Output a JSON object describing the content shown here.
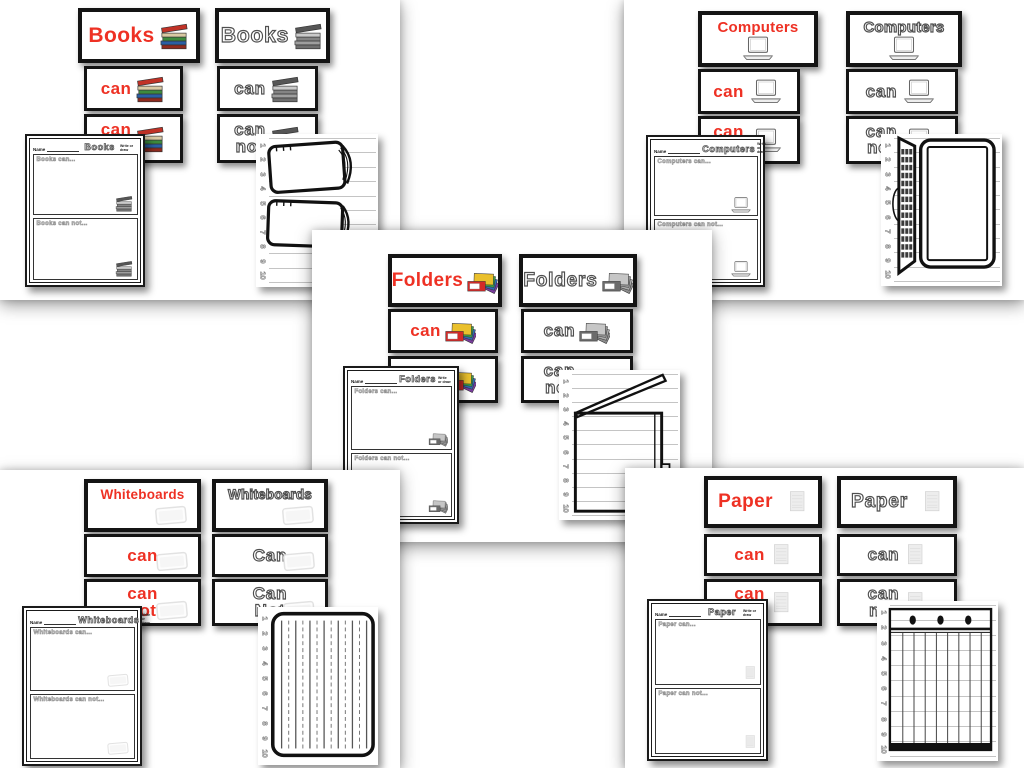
{
  "colors": {
    "accent_red": "#ee3124",
    "card_border": "#141414",
    "outline_text_gray": "#4f4f4f"
  },
  "shared": {
    "name_label": "Name",
    "corner_note": "Write or draw",
    "line_numbers": [
      "1",
      "2",
      "3",
      "4",
      "5",
      "6",
      "7",
      "8",
      "9",
      "10"
    ]
  },
  "sections": [
    {
      "id": "books",
      "title": "Books",
      "cards": {
        "red_title": "Books",
        "red_can": "can",
        "red_cannot_1": "can",
        "red_cannot_2": "not",
        "outline_title": "Books",
        "outline_can": "can",
        "outline_cannot_1": "can",
        "outline_cannot_2": "not"
      },
      "worksheet": {
        "title": "Books",
        "can_prompt": "Books can...",
        "cannot_prompt": "Books can not..."
      }
    },
    {
      "id": "computers",
      "title": "Computers",
      "cards": {
        "red_title": "Computers",
        "red_can": "can",
        "red_cannot_1": "can",
        "red_cannot_2": "not",
        "outline_title": "Computers",
        "outline_can": "can",
        "outline_cannot_1": "can",
        "outline_cannot_2": "not"
      },
      "worksheet": {
        "title": "Computers",
        "can_prompt": "Computers can...",
        "cannot_prompt": "Computers can not..."
      }
    },
    {
      "id": "folders",
      "title": "Folders",
      "cards": {
        "red_title": "Folders",
        "red_can": "can",
        "red_cannot_1": "can",
        "red_cannot_2": "not",
        "outline_title": "Folders",
        "outline_can": "can",
        "outline_cannot_1": "can",
        "outline_cannot_2": "not"
      },
      "worksheet": {
        "title": "Folders",
        "can_prompt": "Folders can...",
        "cannot_prompt": "Folders can not..."
      }
    },
    {
      "id": "whiteboards",
      "title": "Whiteboards",
      "cards": {
        "red_title": "Whiteboards",
        "red_can": "can",
        "red_cannot_1": "can",
        "red_cannot_2": "not",
        "outline_title": "Whiteboards",
        "outline_can": "Can",
        "outline_cannot_1": "Can",
        "outline_cannot_2": "Not"
      },
      "worksheet": {
        "title": "Whiteboards",
        "can_prompt": "Whiteboards can...",
        "cannot_prompt": "Whiteboards can not..."
      }
    },
    {
      "id": "paper",
      "title": "Paper",
      "cards": {
        "red_title": "Paper",
        "red_can": "can",
        "red_cannot_1": "can",
        "red_cannot_2": "not",
        "outline_title": "Paper",
        "outline_can": "can",
        "outline_cannot_1": "can",
        "outline_cannot_2": "not"
      },
      "worksheet": {
        "title": "Paper",
        "can_prompt": "Paper can...",
        "cannot_prompt": "Paper can not..."
      }
    }
  ]
}
